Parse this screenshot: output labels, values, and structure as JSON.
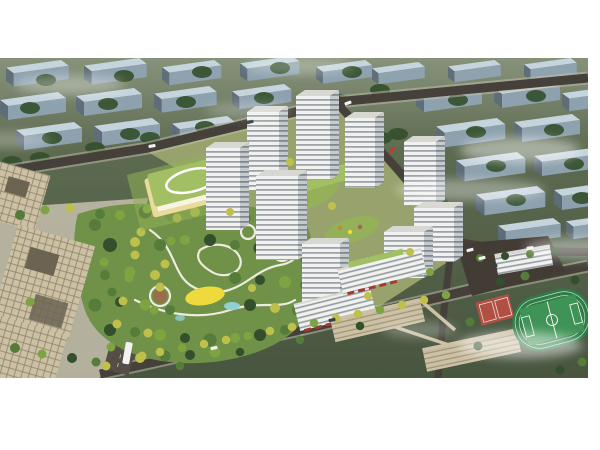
{
  "scene": {
    "kind": "aerial architectural rendering",
    "description": "Bird's-eye masterplan rendering of a residential development: white high-rise towers around landscaped courtyards, a large central park with winding paths and a yellow playground, a green-roofed kindergarten, beige office blocks, a school campus with a green sports field and red courts, tree-lined boulevards, distant gray housing slabs on olive-green terrain and drifting haze."
  },
  "palette": {
    "margin": "#ffffff",
    "bg-top": "#87927a",
    "bg-mid": "#5c6a50",
    "bg-dark": "#48553f",
    "slab-top": "#c9d8e2",
    "slab-face": "#8fa3b2",
    "slab-side": "#5f6d79",
    "road": "#45403a",
    "road-light": "#544e46",
    "paving": "#c6c0ae",
    "path": "#edeadf",
    "complex-ground": "#97a26d",
    "park-base": "#6f9148",
    "grass-light": "#94b058",
    "tree-dark": "#344f2b",
    "tree-mid": "#557c38",
    "tree-light": "#7ea441",
    "tree-yellow": "#bfc04c",
    "tree-orange": "#c08a3e",
    "tower-face": "#f1f2ef",
    "tower-stripe": "#7b848c",
    "tower-side": "#c6cacc",
    "tower-side-stripe": "#646f77",
    "tower-roof": "#d8d8d2",
    "beige": "#ccc1a5",
    "beige-line": "#8d8266",
    "k-roof": "#a2bf64",
    "k-wall": "#e9db9c",
    "play-yellow": "#eeda3c",
    "pond": "#8fd0d5",
    "plaza-red": "#a2674c",
    "field": "#3f9356",
    "track": "#2f7c47",
    "lane": "#c2e1ca",
    "court": "#b14f43",
    "awning": "#a23a2e",
    "car-white": "#f2f2f2",
    "car-red": "#c23b2d",
    "car-dark": "#394046",
    "cloud": "#ffffff"
  }
}
